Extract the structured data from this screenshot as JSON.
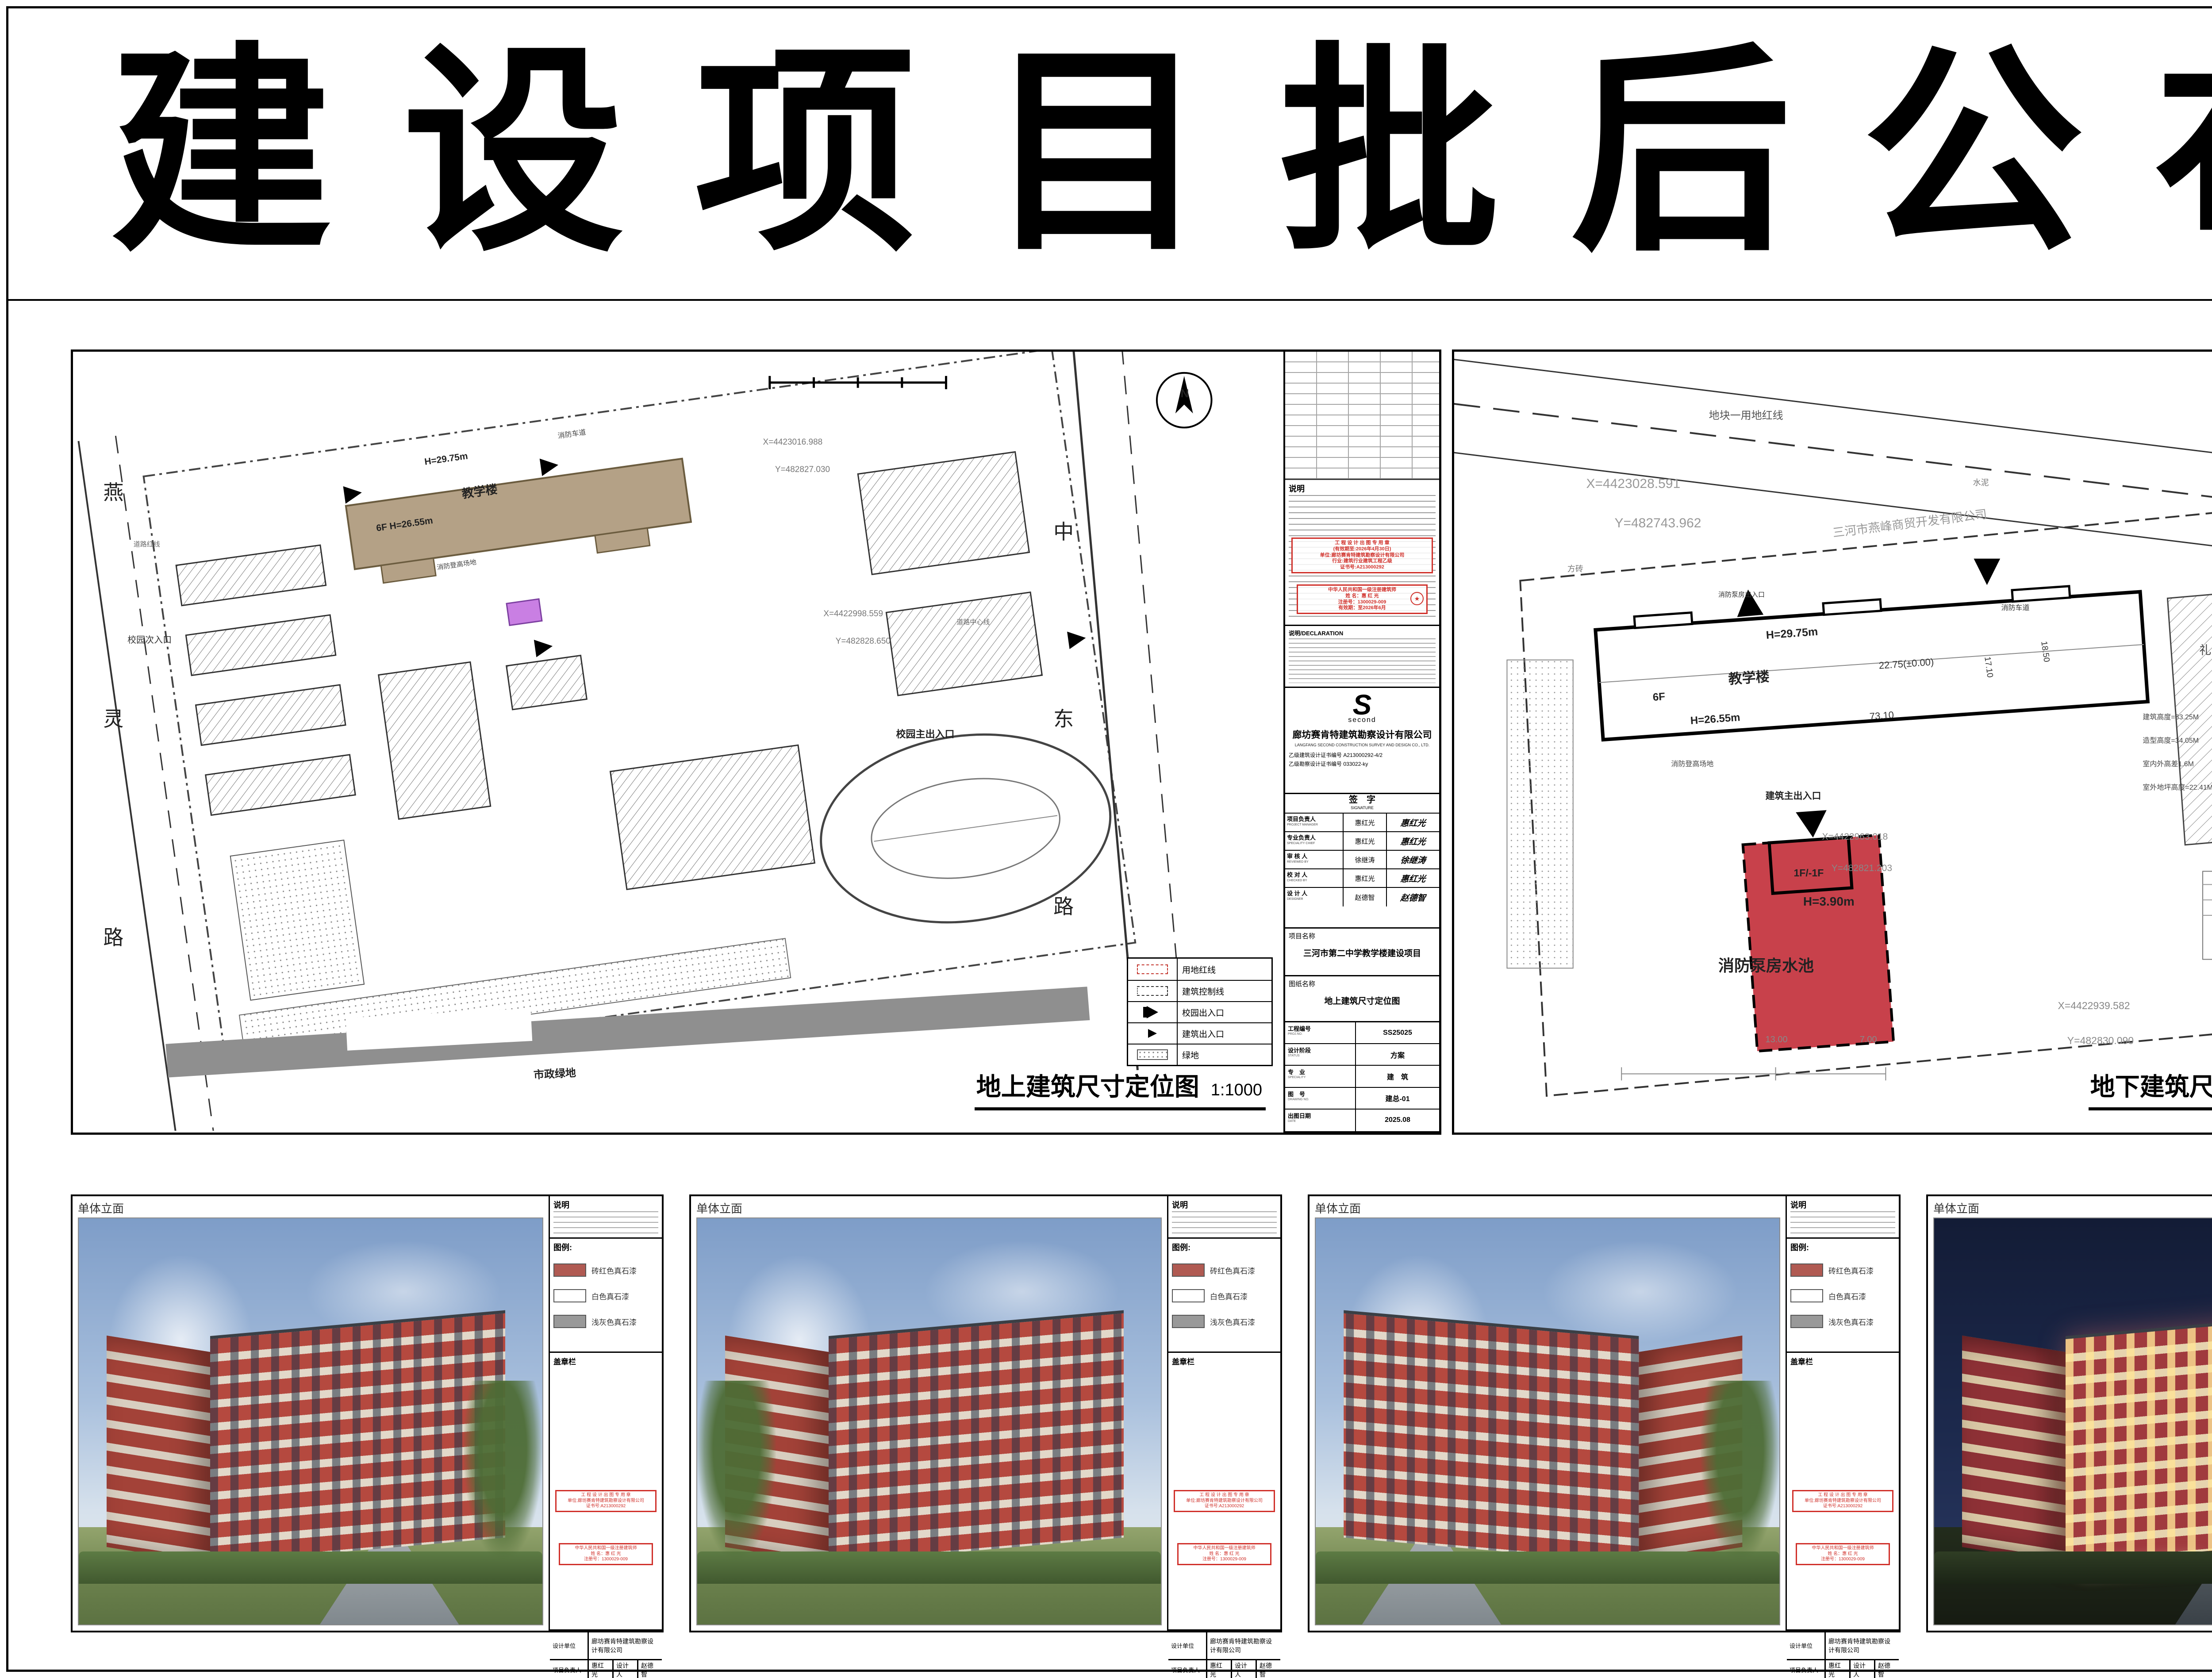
{
  "page": {
    "title": "建设项目批后公布",
    "notice": [
      "此公示根据河北省住建厅(冀建规[2014]36号)",
      "文件，关于进一步加强城乡规划公示公布工作",
      "的指导意见，特此公示"
    ],
    "supervisor": "燕郊高新区行政审批局监制",
    "publish_date": "2025年9月6日"
  },
  "indicators": {
    "heading": "主要经济技术指标",
    "lines": [
      "规划证证号：1310822025GG0034591",
      "建设项目名称：三河市第二中学教学楼建设项目",
      "建设单位名称：河北省三河市第二中学",
      "建设位置：三河市第二中学院内",
      "建筑规模：8523.34平方米",
      "建筑物高度（檐口）及层数：",
      "详尺寸定位图建筑一览表"
    ],
    "metrics": [
      {
        "left": "容积率：≤0.9",
        "right": "绿地率：≥35%"
      },
      {
        "left": "建筑密度：≤30%",
        "right": "建筑高度：≤36米"
      }
    ],
    "legend_label": "拟建建筑：",
    "legend": [
      {
        "color": "#b4a186",
        "label": "教学楼"
      },
      {
        "color": "#c97fe3",
        "label": "消防泵房水池（地上）"
      },
      {
        "color": "#c8414b",
        "label": "消防泵房水池（地下）"
      }
    ],
    "designer": "设计单位：廊坊赛肯特建筑勘察设计有限公司",
    "permit_label": "建设工程规划许可证："
  },
  "certificates": {
    "cover": {
      "nation": "中华人民共和国",
      "title1": "建设工程",
      "title2": "规划许可证",
      "footer": "中华人民共和国自然资源部监制"
    },
    "page": {
      "nation": "中华人民共和国",
      "title": "建设工程规划许可证",
      "serial": "1310822025GG0034591",
      "serial_line": "建字第　　　　　号",
      "body": "根据《中华人民共和国土地管理法》《中华人民共和国城乡规划法》和国家有关规定，经审核，本建设工程符合国土空间规划和用途管制要求，颁发此证。",
      "issuer": "发证机关",
      "date_label": "日　期",
      "seal_star": "★"
    },
    "info": {
      "rows": [
        {
          "k": "建设单位(个人)",
          "v": "河北省三河市第二中学"
        },
        {
          "k": "建设项目名称",
          "v": "三河市第二中学教学楼建设项目"
        },
        {
          "k": "建 设 位 置",
          "v": "燕灵路东侧，第二中学院内"
        },
        {
          "k": "建 设 规 模",
          "v": "8523.34平方米"
        }
      ],
      "attach_label": "附图及附件名称",
      "observe_label": "遵守事项"
    }
  },
  "titleblock": {
    "notes_head": "说明",
    "decl_head": "说明/DECLARATION",
    "logo_glyph": "S",
    "logo_text": "second",
    "company": "廊坊赛肯特建筑勘察设计有限公司",
    "company_en": "LANGFANG SECOND CONSTRUCTION SURVEY AND DESIGN CO., LTD.",
    "cert1": "乙级建筑设计证书编号  A213000292-4/2",
    "cert2": "乙级勘察设计证书编号  033022-ky",
    "sign_title": "签　字",
    "sign_en": "SIGNATURE",
    "sign_rows": [
      {
        "role": "项目负责人",
        "en": "PROJECT MANAGER",
        "name": "惠红光"
      },
      {
        "role": "专业负责人",
        "en": "SPECIALITY CHIEF",
        "name": "惠红光"
      },
      {
        "role": "审 核 人",
        "en": "REVIEWED BY",
        "name": "徐继涛"
      },
      {
        "role": "校 对 人",
        "en": "CHECKED BY",
        "name": "惠红光"
      },
      {
        "role": "设 计 人",
        "en": "DESIGNER",
        "name": "赵德智"
      }
    ],
    "project_label": "项目名称",
    "project_name": "三河市第二中学教学楼建设项目",
    "sheet_label": "图纸名称"
  },
  "plan_fields": {
    "proj": "工程编号",
    "proj_en": "PROJ.NO.",
    "stage": "设计阶段",
    "stage_en": "STATUS",
    "spec": "专　业",
    "spec_en": "SPECIALITY",
    "fig": "图　号",
    "fig_en": "DRAWING NO.",
    "date": "出图日期",
    "date_en": "DATE"
  },
  "stamps": {
    "s1": [
      "工 程 设 计 出 图 专 用 章",
      "(有效期至:2026年4月30日)",
      "单位:廊坊赛肯特建筑勘察设计有限公司",
      "行业:建筑行业建筑工程乙级",
      "证书号:A213000292"
    ],
    "s2_title": "中华人民共和国一级注册建筑师",
    "s2_lines": [
      "姓 名：惠 红 光",
      "注册号：1300029-009",
      "有效期：至2026年6月"
    ],
    "s2_star": "★"
  },
  "map_legend": {
    "items": [
      {
        "label": "用地红线"
      },
      {
        "label": "建筑控制线"
      },
      {
        "label": "校园出入口"
      },
      {
        "label": "建筑出入口"
      },
      {
        "label": "绿地"
      }
    ]
  },
  "plans": [
    {
      "drawing_name": "地上建筑尺寸定位图",
      "scale": "1:1000",
      "proj_no": "SS25025",
      "stage": "方案",
      "spec": "建　筑",
      "fig_no": "建总-01",
      "date": "2025.08",
      "labels": [
        {
          "t": "燕",
          "x": "2.5%",
          "y": "16%",
          "s": "46px",
          "w": "400"
        },
        {
          "t": "灵",
          "x": "2.5%",
          "y": "45%",
          "s": "46px",
          "w": "400"
        },
        {
          "t": "路",
          "x": "2.5%",
          "y": "73%",
          "s": "46px",
          "w": "400"
        },
        {
          "t": "校园次入口",
          "x": "4.5%",
          "y": "36%",
          "s": "20px",
          "c": "#333"
        },
        {
          "t": "道路红线",
          "x": "5%",
          "y": "24%",
          "s": "15px",
          "c": "#666"
        },
        {
          "t": "中",
          "x": "81%",
          "y": "21%",
          "s": "46px",
          "w": "400"
        },
        {
          "t": "东",
          "x": "81%",
          "y": "45%",
          "s": "46px",
          "w": "400"
        },
        {
          "t": "路",
          "x": "81%",
          "y": "69%",
          "s": "46px",
          "w": "400"
        },
        {
          "t": "校园主出入口",
          "x": "68%",
          "y": "48%",
          "s": "22px",
          "w": "700"
        },
        {
          "t": "道路中心线",
          "x": "73%",
          "y": "34%",
          "s": "15px",
          "c": "#666"
        },
        {
          "t": "H=29.75m",
          "x": "29%",
          "y": "13.5%",
          "s": "21px",
          "w": "700",
          "r": "rotate(-8deg)"
        },
        {
          "t": "教学楼",
          "x": "32%",
          "y": "17%",
          "s": "27px",
          "w": "700",
          "r": "rotate(-8deg)"
        },
        {
          "t": "6F  H=26.55m",
          "x": "25%",
          "y": "22%",
          "s": "21px",
          "w": "700",
          "r": "rotate(-8deg)"
        },
        {
          "t": "消防车道",
          "x": "40%",
          "y": "10%",
          "s": "16px",
          "c": "#444",
          "r": "rotate(-8deg)"
        },
        {
          "t": "消防登高场地",
          "x": "30%",
          "y": "27%",
          "s": "15px",
          "c": "#444",
          "r": "rotate(-8deg)"
        },
        {
          "t": "X=4423016.988",
          "x": "57%",
          "y": "11%",
          "s": "19px",
          "c": "#777"
        },
        {
          "t": "Y=482827.030",
          "x": "58%",
          "y": "14.5%",
          "s": "19px",
          "c": "#777"
        },
        {
          "t": "X=4422998.559",
          "x": "62%",
          "y": "33%",
          "s": "19px",
          "c": "#777"
        },
        {
          "t": "Y=482828.650",
          "x": "63%",
          "y": "36.5%",
          "s": "19px",
          "c": "#777"
        },
        {
          "t": "市政绿地",
          "x": "38%",
          "y": "91.5%",
          "s": "24px",
          "w": "700",
          "c": "#222",
          "r": "rotate(-3deg)"
        },
        {
          "t": "N",
          "x": "91.5%",
          "y": "4.5%",
          "s": "26px",
          "w": "700"
        }
      ]
    },
    {
      "drawing_name": "地下建筑尺寸定位图",
      "scale": "1:1000",
      "proj_no": "SS25025",
      "stage": "方案",
      "spec": "建　筑",
      "fig_no": "建总-02",
      "date": "2025.08",
      "labels": [
        {
          "t": "地块一用地红线",
          "x": "27%",
          "y": "7%",
          "s": "24px",
          "c": "#555"
        },
        {
          "t": "X=4423028.591",
          "x": "14%",
          "y": "16%",
          "s": "30px",
          "c": "#999"
        },
        {
          "t": "Y=482743.962",
          "x": "17%",
          "y": "21%",
          "s": "30px",
          "c": "#999"
        },
        {
          "t": "三河市燕峰商贸开发有限公司",
          "x": "40%",
          "y": "22%",
          "s": "27px",
          "c": "#999",
          "r": "rotate(-7deg)"
        },
        {
          "t": "水泥",
          "x": "55%",
          "y": "16%",
          "s": "18px",
          "c": "#777"
        },
        {
          "t": "方砖",
          "x": "12%",
          "y": "27%",
          "s": "18px",
          "c": "#777"
        },
        {
          "t": "机动车停车场(P)",
          "x": "82%",
          "y": "19%",
          "s": "14px",
          "c": "#777"
        },
        {
          "t": "消防泵房出入口",
          "x": "28%",
          "y": "30.5%",
          "s": "15px",
          "c": "#333"
        },
        {
          "t": "消防车道",
          "x": "58%",
          "y": "32%",
          "s": "16px",
          "c": "#333"
        },
        {
          "t": "H=29.75m",
          "x": "33%",
          "y": "35.5%",
          "s": "25px",
          "w": "700",
          "r": "rotate(-4deg)"
        },
        {
          "t": "教学楼",
          "x": "29%",
          "y": "40.5%",
          "s": "31px",
          "w": "700",
          "r": "rotate(-4deg)"
        },
        {
          "t": "6F",
          "x": "21%",
          "y": "43.5%",
          "s": "24px",
          "w": "700",
          "r": "rotate(-4deg)"
        },
        {
          "t": "H=26.55m",
          "x": "25%",
          "y": "46.5%",
          "s": "24px",
          "w": "700",
          "r": "rotate(-4deg)"
        },
        {
          "t": "22.75(±0.00)",
          "x": "45%",
          "y": "39.5%",
          "s": "22px",
          "c": "#333",
          "r": "rotate(-4deg)"
        },
        {
          "t": "73.10",
          "x": "44%",
          "y": "46%",
          "s": "22px",
          "c": "#333",
          "r": "rotate(-4deg)"
        },
        {
          "t": "17.10",
          "x": "57%",
          "y": "39%",
          "s": "19px",
          "c": "#333",
          "r": "rotate(82deg)"
        },
        {
          "t": "18.50",
          "x": "63%",
          "y": "37%",
          "s": "19px",
          "c": "#333",
          "r": "rotate(82deg)"
        },
        {
          "t": "消防登高场地",
          "x": "23%",
          "y": "52%",
          "s": "16px",
          "c": "#444"
        },
        {
          "t": "建筑主出入口",
          "x": "33%",
          "y": "56%",
          "s": "21px",
          "w": "700"
        },
        {
          "t": "X=4422963.018",
          "x": "39%",
          "y": "61.5%",
          "s": "21px",
          "c": "#888"
        },
        {
          "t": "Y=482821.203",
          "x": "40%",
          "y": "65.5%",
          "s": "21px",
          "c": "#888"
        },
        {
          "t": "礼　堂",
          "x": "79%",
          "y": "37%",
          "s": "27px",
          "c": "#444"
        },
        {
          "t": "建筑高度=33.25M",
          "x": "73%",
          "y": "46%",
          "s": "16px",
          "c": "#444"
        },
        {
          "t": "造型高度=34.05M",
          "x": "73%",
          "y": "49%",
          "s": "16px",
          "c": "#444"
        },
        {
          "t": "室内外高差1.6M",
          "x": "73%",
          "y": "52%",
          "s": "16px",
          "c": "#444"
        },
        {
          "t": "室外地坪高度=22.41M",
          "x": "73%",
          "y": "55%",
          "s": "16px",
          "c": "#444"
        },
        {
          "t": "1F/-1F",
          "x": "36%",
          "y": "66%",
          "s": "23px",
          "w": "700"
        },
        {
          "t": "H=3.90m",
          "x": "37%",
          "y": "69.5%",
          "s": "28px",
          "w": "700"
        },
        {
          "t": "消防泵房水池",
          "x": "28%",
          "y": "77%",
          "s": "36px",
          "w": "700"
        },
        {
          "t": "13.00",
          "x": "33%",
          "y": "87.5%",
          "s": "20px",
          "c": "#888"
        },
        {
          "t": "7.00",
          "x": "43%",
          "y": "87.5%",
          "s": "20px",
          "c": "#888"
        },
        {
          "t": "X=4422939.582",
          "x": "64%",
          "y": "83%",
          "s": "23px",
          "c": "#888"
        },
        {
          "t": "Y=482830.090",
          "x": "65%",
          "y": "87.5%",
          "s": "23px",
          "c": "#888"
        }
      ]
    }
  ],
  "renderings": {
    "header": "单体立面",
    "panels": [
      {
        "variant": "day"
      },
      {
        "variant": "day"
      },
      {
        "variant": "day flip"
      },
      {
        "variant": "night"
      }
    ],
    "strip": {
      "note_label": "说明",
      "legend_title": "图例:",
      "legend": [
        {
          "color": "#b05a52",
          "label": "砖红色真石漆"
        },
        {
          "color": "#ffffff",
          "label": "白色真石漆"
        },
        {
          "color": "#999999",
          "label": "浅灰色真石漆"
        }
      ],
      "seal_label": "盖章栏",
      "design_unit_label": "设计单位",
      "design_unit": "廊坊赛肯特建筑勘察设计有限公司",
      "pm_label": "项目负责人",
      "pm": "惠红光",
      "designer_label": "设计人",
      "designer": "赵德智",
      "sign_label": "签字栏",
      "signatures": "惠红光　赵德智"
    }
  }
}
